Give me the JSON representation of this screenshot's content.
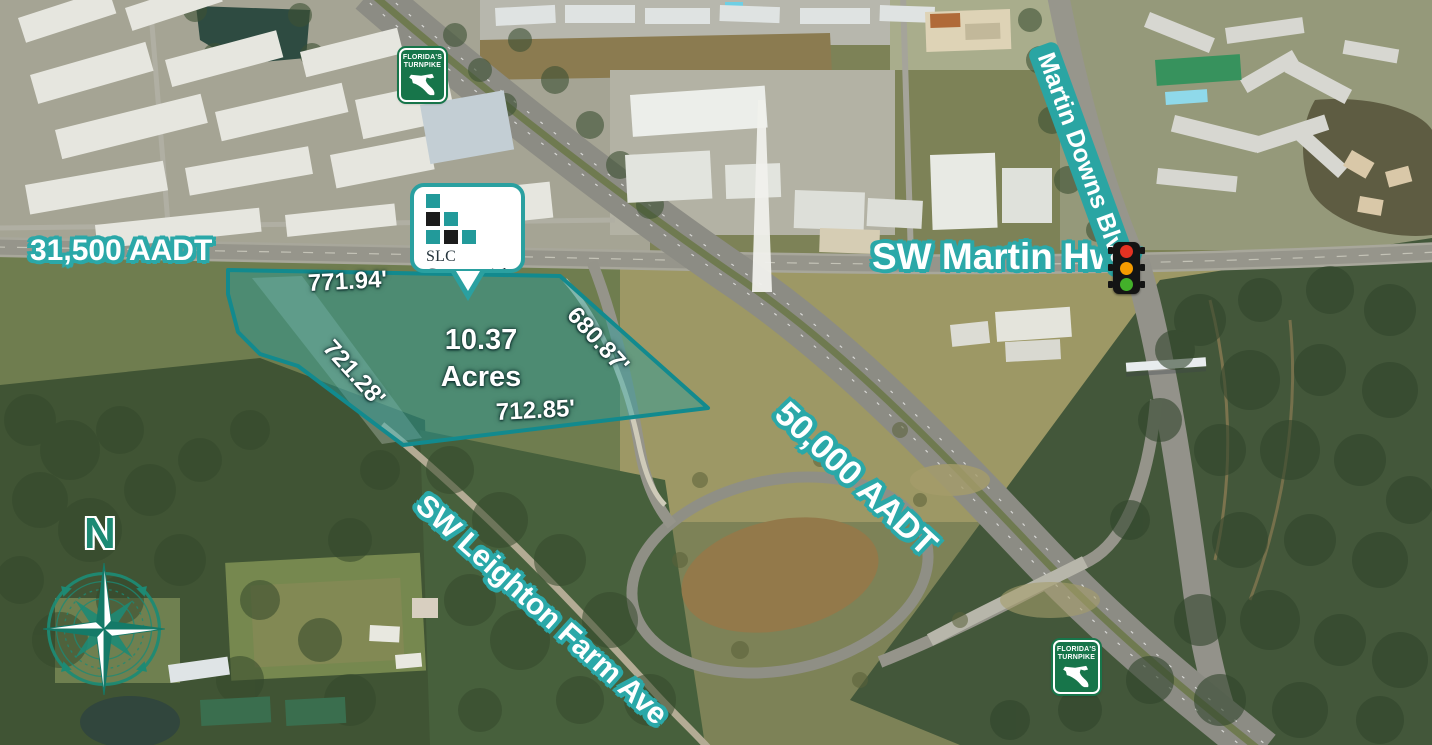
{
  "annotations": {
    "traffic_counts": [
      {
        "label": "31,500 AADT"
      },
      {
        "label": "50,000 AADT"
      }
    ],
    "roads": {
      "martin_hwy": "SW Martin Hwy",
      "martin_downs_blvd": "Martin Downs Blvd",
      "leighton_farm_ave": "SW Leighton Farm Ave"
    }
  },
  "parcel": {
    "acres_value": "10.37",
    "acres_unit": "Acres",
    "dimensions": {
      "north": "771.94'",
      "east": "680.87'",
      "southwest": "721.28'",
      "south": "712.85'"
    }
  },
  "broker_logo": {
    "name": "SLC Commercial",
    "tagline": "Realty Associates"
  },
  "turnpike_shield": {
    "line1": "FLORIDA'S",
    "line2": "TURNPIKE"
  },
  "compass": {
    "north": "N"
  },
  "colors": {
    "accent_teal": "#2ba8a8",
    "parcel_fill": "rgba(35,158,158,0.45)",
    "parcel_stroke": "#128a8e",
    "shield_green": "#17754a",
    "compass_teal": "#1d8a74",
    "traffic_light_red": "#e53222",
    "traffic_light_amber": "#f59b00",
    "traffic_light_green": "#43b02a"
  }
}
